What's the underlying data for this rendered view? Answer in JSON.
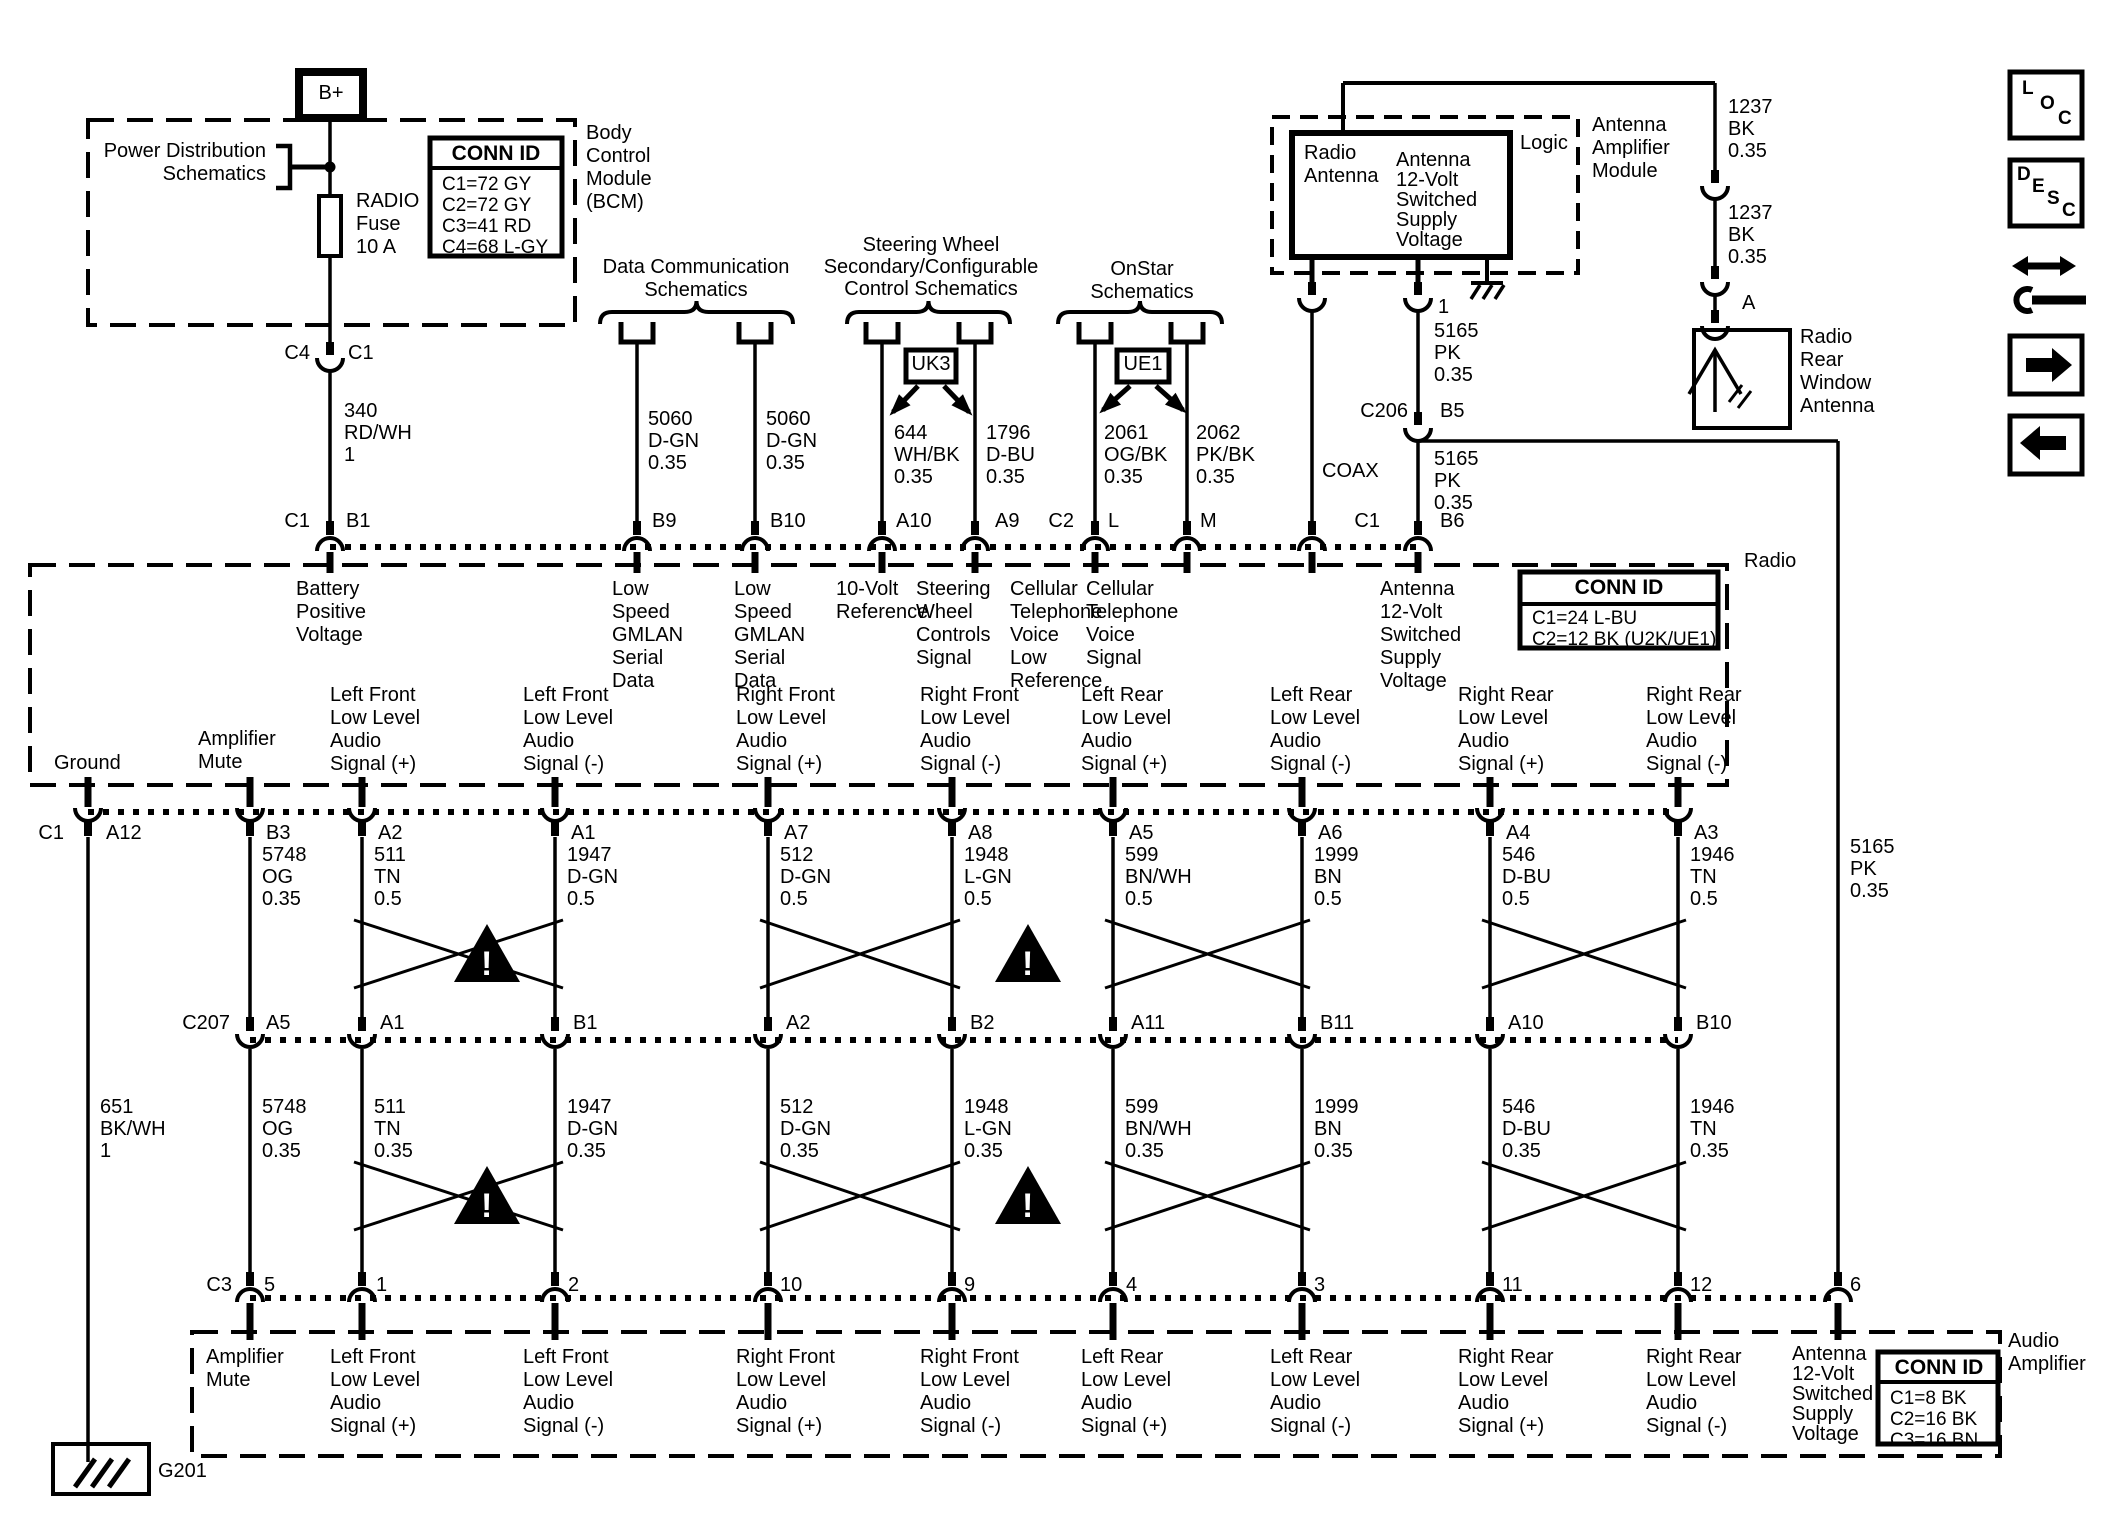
{
  "warning_mark": "!",
  "top_left": {
    "b_plus": "B+",
    "power_dist": "Power Distribution\nSchematics",
    "fuse_label": "RADIO\nFuse\n10 A",
    "bcm_conn": {
      "title": "CONN ID",
      "rows": "C1=72 GY\nC2=72 GY\nC3=41 RD\nC4=68 L-GY"
    },
    "bcm_label": "Body\nControl\nModule\n(BCM)",
    "pin_c4": "C4",
    "pin_c1": "C1",
    "wire_340": "340\nRD/WH\n1"
  },
  "branches": {
    "data_comm": {
      "title": "Data Communication\nSchematics",
      "wire_left": "5060\nD-GN\n0.35",
      "wire_right": "5060\nD-GN\n0.35"
    },
    "steering": {
      "title": "Steering Wheel\nSecondary/Configurable\nControl Schematics",
      "tag": "UK3",
      "wire_left": "644\nWH/BK\n0.35",
      "wire_right": "1796\nD-BU\n0.35"
    },
    "onstar": {
      "title": "OnStar\nSchematics",
      "tag": "UE1",
      "wire_left": "2061\nOG/BK\n0.35",
      "wire_right": "2062\nPK/BK\n0.35"
    }
  },
  "antenna_module": {
    "inner_title": "Radio\nAntenna",
    "inner_signal": "Antenna\n12-Volt\nSwitched\nSupply\nVoltage",
    "logic": "Logic",
    "module_label": "Antenna\nAmplifier\nModule",
    "pin_1": "1",
    "wire_5165_a": "5165\nPK\n0.35",
    "c206": "C206",
    "pin_b5": "B5",
    "wire_5165_b": "5165\nPK\n0.35",
    "coax": "COAX"
  },
  "right_side": {
    "wire_1237_a": "1237\nBK\n0.35",
    "wire_1237_b": "1237\nBK\n0.35",
    "pin_a": "A",
    "rear_antenna": "Radio\nRear\nWindow\nAntenna",
    "icons": {
      "loc": [
        "L",
        "O",
        "C"
      ],
      "desc": [
        "D",
        "E",
        "S",
        "C"
      ]
    }
  },
  "radio": {
    "label": "Radio",
    "conn": {
      "title": "CONN ID",
      "rows": "C1=24 L-BU\nC2=12 BK (U2K/UE1)"
    },
    "top_pins": {
      "c1": "C1",
      "b1": "B1",
      "b9": "B9",
      "b10": "B10",
      "a10": "A10",
      "a9": "A9",
      "c2": "C2",
      "l": "L",
      "m": "M",
      "c1b": "C1",
      "b6": "B6"
    },
    "top_signals": {
      "battery": "Battery\nPositive\nVoltage",
      "gmlan1": "Low\nSpeed\nGMLAN\nSerial\nData",
      "gmlan2": "Low\nSpeed\nGMLAN\nSerial\nData",
      "ref10v": "10-Volt\nReference",
      "swc": "Steering\nWheel\nControls\nSignal",
      "cell_low": "Cellular\nTelephone\nVoice\nLow\nReference",
      "cell_sig": "Cellular\nTelephone\nVoice\nSignal",
      "ant12v": "Antenna\n12-Volt\nSwitched\nSupply\nVoltage"
    },
    "bottom_signals": [
      "Ground",
      "Amplifier\nMute",
      "Left Front\nLow Level\nAudio\nSignal (+)",
      "Left Front\nLow Level\nAudio\nSignal (-)",
      "Right Front\nLow Level\nAudio\nSignal (+)",
      "Right Front\nLow Level\nAudio\nSignal (-)",
      "Left Rear\nLow Level\nAudio\nSignal (+)",
      "Left Rear\nLow Level\nAudio\nSignal (-)",
      "Right Rear\nLow Level\nAudio\nSignal (+)",
      "Right Rear\nLow Level\nAudio\nSignal (-)"
    ],
    "bottom_pins": [
      "C1",
      "A12",
      "B3",
      "A2",
      "A1",
      "A7",
      "A8",
      "A5",
      "A6",
      "A4",
      "A3"
    ]
  },
  "wires_upper": [
    "5748\nOG\n0.35",
    "511\nTN\n0.5",
    "1947\nD-GN\n0.5",
    "512\nD-GN\n0.5",
    "1948\nL-GN\n0.5",
    "599\nBN/WH\n0.5",
    "1999\nBN\n0.5",
    "546\nD-BU\n0.5",
    "1946\nTN\n0.5"
  ],
  "wire_651": "651\nBK/WH\n1",
  "wire_5165_right": "5165\nPK\n0.35",
  "c207": {
    "label": "C207",
    "pins": [
      "A5",
      "A1",
      "B1",
      "A2",
      "B2",
      "A11",
      "B11",
      "A10",
      "B10"
    ]
  },
  "wires_lower": [
    "5748\nOG\n0.35",
    "511\nTN\n0.35",
    "1947\nD-GN\n0.35",
    "512\nD-GN\n0.35",
    "1948\nL-GN\n0.35",
    "599\nBN/WH\n0.35",
    "1999\nBN\n0.35",
    "546\nD-BU\n0.35",
    "1946\nTN\n0.35"
  ],
  "amp": {
    "label": "Audio\nAmplifier",
    "conn": {
      "title": "CONN ID",
      "rows": "C1=8 BK\nC2=16 BK\nC3=16 BN"
    },
    "top_pins": [
      "C3",
      "5",
      "1",
      "2",
      "10",
      "9",
      "4",
      "3",
      "11",
      "12",
      "6"
    ],
    "signals": [
      "Amplifier\nMute",
      "Left Front\nLow Level\nAudio\nSignal (+)",
      "Left Front\nLow Level\nAudio\nSignal (-)",
      "Right Front\nLow Level\nAudio\nSignal (+)",
      "Right Front\nLow Level\nAudio\nSignal (-)",
      "Left Rear\nLow Level\nAudio\nSignal (+)",
      "Left Rear\nLow Level\nAudio\nSignal (-)",
      "Right Rear\nLow Level\nAudio\nSignal (+)",
      "Right Rear\nLow Level\nAudio\nSignal (-)",
      "Antenna\n12-Volt\nSwitched\nSupply\nVoltage"
    ]
  },
  "ground": {
    "g201": "G201"
  }
}
